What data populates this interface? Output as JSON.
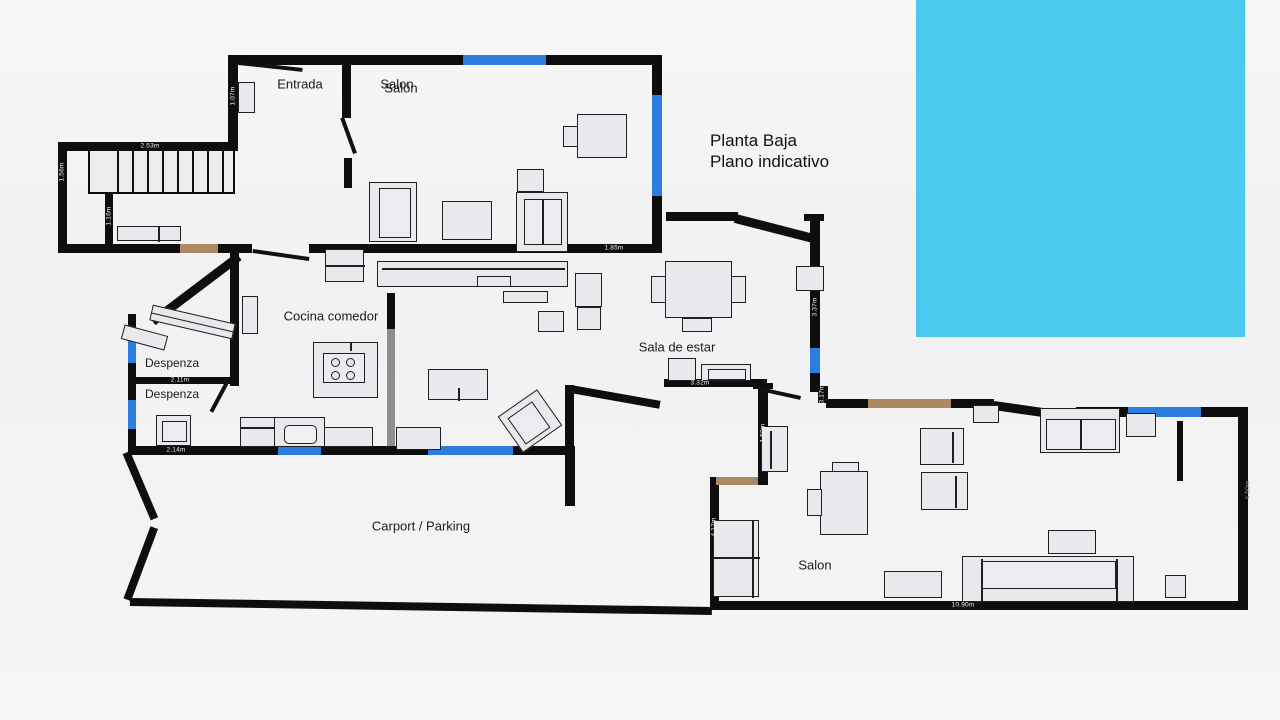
{
  "title": {
    "line1": "Planta Baja",
    "line2": "Plano indicativo"
  },
  "colors": {
    "wall": "#0e0e0e",
    "window_marker": "#2b7de0",
    "door_marker": "#ab8a63",
    "pool": "#4dc9f0",
    "furniture_fill": "#e9e9ed",
    "furniture_border": "#1f1f1f",
    "partition_gray": "#8f8f8f",
    "background": "#f3f3f4",
    "label_text": "#1b1b1b"
  },
  "pool": {
    "name": "swimming-pool",
    "x": 916,
    "y": 0,
    "w": 329,
    "h": 337
  },
  "room_labels": [
    {
      "name": "room-label-entrada",
      "text": "Entrada",
      "x": 300,
      "y": 84,
      "size": 13
    },
    {
      "name": "room-label-salon-top",
      "text": "Salon",
      "x": 397,
      "y": 84,
      "size": 13
    },
    {
      "name": "room-label-salon-top-alt",
      "text": "Salón",
      "x": 401,
      "y": 88,
      "size": 13
    },
    {
      "name": "room-label-cocina",
      "text": "Cocina comedor",
      "x": 331,
      "y": 316,
      "size": 13
    },
    {
      "name": "room-label-sala-de-estar",
      "text": "Sala de estar",
      "x": 677,
      "y": 347,
      "size": 13
    },
    {
      "name": "room-label-despenza-1",
      "text": "Despenza",
      "x": 172,
      "y": 363,
      "size": 12
    },
    {
      "name": "room-label-despenza-2",
      "text": "Despenza",
      "x": 172,
      "y": 394,
      "size": 12
    },
    {
      "name": "room-label-carport",
      "text": "Carport / Parking",
      "x": 421,
      "y": 526,
      "size": 13
    },
    {
      "name": "room-label-salon-bottom",
      "text": "Salon",
      "x": 815,
      "y": 565,
      "size": 13
    }
  ],
  "dimension_labels": [
    {
      "text": "2.53m",
      "x": 150,
      "y": 146,
      "rot": false
    },
    {
      "text": "1.56m",
      "x": 62,
      "y": 172,
      "rot": true
    },
    {
      "text": "1.16m",
      "x": 109,
      "y": 216,
      "rot": true
    },
    {
      "text": "1.07m",
      "x": 233,
      "y": 96,
      "rot": true
    },
    {
      "text": "2.72m",
      "x": 483,
      "y": 291,
      "rot": false
    },
    {
      "text": "1.85m",
      "x": 614,
      "y": 248,
      "rot": false
    },
    {
      "text": "1.54m",
      "x": 569,
      "y": 322,
      "rot": true
    },
    {
      "text": "2.11m",
      "x": 180,
      "y": 380,
      "rot": false
    },
    {
      "text": "2.14m",
      "x": 176,
      "y": 450,
      "rot": false
    },
    {
      "text": "3.37m",
      "x": 815,
      "y": 307,
      "rot": true
    },
    {
      "text": "3.32m",
      "x": 700,
      "y": 383,
      "rot": false
    },
    {
      "text": "3.17m",
      "x": 822,
      "y": 394,
      "rot": true
    },
    {
      "text": "1.50m",
      "x": 763,
      "y": 433,
      "rot": true
    },
    {
      "text": "4.17m",
      "x": 714,
      "y": 527,
      "rot": true
    },
    {
      "text": "10.90m",
      "x": 963,
      "y": 605,
      "rot": false
    },
    {
      "text": "4.50m",
      "x": 1248,
      "y": 490,
      "rot": true,
      "dark": true
    }
  ],
  "plan": {
    "walls": [
      {
        "x": 228,
        "y": 55,
        "w": 434,
        "h": 10
      },
      {
        "x": 228,
        "y": 55,
        "w": 10,
        "h": 92
      },
      {
        "x": 58,
        "y": 142,
        "w": 180,
        "h": 9
      },
      {
        "x": 58,
        "y": 142,
        "w": 9,
        "h": 111
      },
      {
        "x": 58,
        "y": 244,
        "w": 600,
        "h": 9
      },
      {
        "x": 105,
        "y": 190,
        "w": 8,
        "h": 58
      },
      {
        "x": 342,
        "y": 55,
        "w": 9,
        "h": 63
      },
      {
        "x": 344,
        "y": 158,
        "w": 8,
        "h": 30
      },
      {
        "x": 652,
        "y": 55,
        "w": 10,
        "h": 198
      },
      {
        "x": 666,
        "y": 212,
        "w": 72,
        "h": 9
      },
      {
        "x": 804,
        "y": 214,
        "w": 20,
        "h": 7
      },
      {
        "x": 810,
        "y": 216,
        "w": 10,
        "h": 176
      },
      {
        "x": 230,
        "y": 252,
        "w": 9,
        "h": 134
      },
      {
        "x": 128,
        "y": 314,
        "w": 8,
        "h": 141
      },
      {
        "x": 128,
        "y": 377,
        "w": 108,
        "h": 7
      },
      {
        "x": 128,
        "y": 446,
        "w": 447,
        "h": 9
      },
      {
        "x": 565,
        "y": 446,
        "w": 10,
        "h": 60
      },
      {
        "x": 565,
        "y": 385,
        "w": 9,
        "h": 64
      },
      {
        "x": 664,
        "y": 379,
        "w": 103,
        "h": 8
      },
      {
        "x": 753,
        "y": 383,
        "w": 20,
        "h": 6
      },
      {
        "x": 758,
        "y": 385,
        "w": 10,
        "h": 99
      },
      {
        "x": 710,
        "y": 477,
        "w": 58,
        "h": 8
      },
      {
        "x": 710,
        "y": 477,
        "w": 9,
        "h": 133
      },
      {
        "x": 818,
        "y": 386,
        "w": 10,
        "h": 17
      },
      {
        "x": 826,
        "y": 399,
        "w": 168,
        "h": 9
      },
      {
        "x": 1076,
        "y": 407,
        "w": 172,
        "h": 10
      },
      {
        "x": 1238,
        "y": 407,
        "w": 10,
        "h": 203
      },
      {
        "x": 710,
        "y": 601,
        "w": 538,
        "h": 9
      },
      {
        "x": 1177,
        "y": 421,
        "w": 6,
        "h": 60
      },
      {
        "x": 387,
        "y": 293,
        "w": 8,
        "h": 153,
        "color": "#8f8f8f"
      },
      {
        "x": 387,
        "y": 293,
        "w": 8,
        "h": 36
      }
    ],
    "diagonal_walls": [
      {
        "x1": 736,
        "y1": 214,
        "x2": 814,
        "y2": 234,
        "t": 9
      },
      {
        "x1": 150,
        "y1": 318,
        "x2": 236,
        "y2": 253,
        "t": 9
      },
      {
        "x1": 571,
        "y1": 385,
        "x2": 661,
        "y2": 401,
        "t": 8
      },
      {
        "x1": 994,
        "y1": 401,
        "x2": 1078,
        "y2": 413,
        "t": 9
      },
      {
        "x1": 130,
        "y1": 451,
        "x2": 158,
        "y2": 517,
        "t": 8
      },
      {
        "x1": 158,
        "y1": 529,
        "x2": 131,
        "y2": 601,
        "t": 8
      },
      {
        "x1": 130,
        "y1": 598,
        "x2": 712,
        "y2": 607,
        "t": 8
      }
    ],
    "wall_gaps": [
      {
        "x": 252,
        "y": 243,
        "w": 57,
        "h": 11
      }
    ],
    "windows": [
      {
        "x": 463,
        "y": 55,
        "w": 83,
        "h": 10
      },
      {
        "x": 652,
        "y": 95,
        "w": 10,
        "h": 101
      },
      {
        "x": 810,
        "y": 348,
        "w": 10,
        "h": 25
      },
      {
        "x": 128,
        "y": 337,
        "w": 8,
        "h": 26
      },
      {
        "x": 128,
        "y": 400,
        "w": 8,
        "h": 29
      },
      {
        "x": 278,
        "y": 446,
        "w": 43,
        "h": 9
      },
      {
        "x": 428,
        "y": 446,
        "w": 85,
        "h": 9
      },
      {
        "x": 1128,
        "y": 407,
        "w": 73,
        "h": 10
      }
    ],
    "doors": [
      {
        "x": 180,
        "y": 244,
        "w": 38,
        "h": 9
      },
      {
        "x": 868,
        "y": 399,
        "w": 83,
        "h": 9
      },
      {
        "x": 716,
        "y": 477,
        "w": 42,
        "h": 8
      }
    ],
    "door_leaves": [
      {
        "x1": 239,
        "y1": 61,
        "x2": 303,
        "y2": 68
      },
      {
        "x1": 344,
        "y1": 117,
        "x2": 357,
        "y2": 153
      },
      {
        "x1": 253,
        "y1": 249,
        "x2": 309,
        "y2": 257
      },
      {
        "x1": 230,
        "y1": 381,
        "x2": 213,
        "y2": 413
      },
      {
        "x1": 760,
        "y1": 387,
        "x2": 801,
        "y2": 396
      }
    ],
    "stairs": {
      "x": 88,
      "y": 149,
      "w": 147,
      "h": 45,
      "risers": [
        27,
        42,
        57,
        72,
        87,
        102,
        117,
        132
      ]
    },
    "furniture": [
      {
        "name": "wardrobe",
        "x": 238,
        "y": 82,
        "w": 17,
        "h": 31
      },
      {
        "name": "bench",
        "x": 117,
        "y": 226,
        "w": 64,
        "h": 15,
        "inner": [
          {
            "kind": "line",
            "x": 40,
            "y": 0,
            "w": 1.5,
            "h": 15
          }
        ]
      },
      {
        "name": "desk",
        "x": 577,
        "y": 114,
        "w": 50,
        "h": 44
      },
      {
        "name": "desk-chair",
        "x": 563,
        "y": 126,
        "w": 15,
        "h": 21
      },
      {
        "name": "side-table",
        "x": 517,
        "y": 169,
        "w": 27,
        "h": 23
      },
      {
        "name": "sofa",
        "x": 369,
        "y": 182,
        "w": 48,
        "h": 60,
        "inner": [
          {
            "kind": "rect",
            "x": 9,
            "y": 5,
            "w": 32,
            "h": 50
          }
        ]
      },
      {
        "name": "coffee-table",
        "x": 442,
        "y": 201,
        "w": 50,
        "h": 39
      },
      {
        "name": "armchair",
        "x": 516,
        "y": 192,
        "w": 52,
        "h": 60,
        "inner": [
          {
            "kind": "rect",
            "x": 7,
            "y": 6,
            "w": 38,
            "h": 46
          },
          {
            "kind": "line",
            "x": 25,
            "y": 6,
            "w": 1.5,
            "h": 46
          }
        ]
      },
      {
        "name": "sideboard",
        "x": 377,
        "y": 261,
        "w": 191,
        "h": 26,
        "inner": [
          {
            "kind": "line",
            "x": 4,
            "y": 6,
            "w": 183,
            "h": 1.5
          }
        ]
      },
      {
        "name": "shelf-box",
        "x": 477,
        "y": 276,
        "w": 34,
        "h": 11
      },
      {
        "name": "shelf",
        "x": 503,
        "y": 291,
        "w": 45,
        "h": 12
      },
      {
        "name": "fridge",
        "x": 325,
        "y": 249,
        "w": 39,
        "h": 33,
        "inner": [
          {
            "kind": "line",
            "x": 0,
            "y": 15,
            "w": 39,
            "h": 1.5
          }
        ]
      },
      {
        "name": "tall-cabinet",
        "x": 242,
        "y": 296,
        "w": 16,
        "h": 38
      },
      {
        "name": "kitchen-island",
        "x": 313,
        "y": 342,
        "w": 65,
        "h": 56,
        "inner": [
          {
            "kind": "rect",
            "x": 9,
            "y": 10,
            "w": 42,
            "h": 30
          },
          {
            "kind": "circle",
            "cx": 21,
            "cy": 19,
            "r": 4.5
          },
          {
            "kind": "circle",
            "cx": 36,
            "cy": 19,
            "r": 4.5
          },
          {
            "kind": "circle",
            "cx": 21,
            "cy": 32,
            "r": 4.5
          },
          {
            "kind": "circle",
            "cx": 36,
            "cy": 32,
            "r": 4.5
          },
          {
            "kind": "line",
            "x": 36,
            "y": 0,
            "w": 1.5,
            "h": 8
          }
        ]
      },
      {
        "name": "cabinet",
        "x": 240,
        "y": 417,
        "w": 35,
        "h": 30,
        "inner": [
          {
            "kind": "line",
            "x": 0,
            "y": 9,
            "w": 35,
            "h": 1.5
          }
        ]
      },
      {
        "name": "sink-unit",
        "x": 274,
        "y": 417,
        "w": 51,
        "h": 30,
        "inner": [
          {
            "kind": "round",
            "x": 9,
            "y": 7,
            "w": 33,
            "h": 19
          }
        ]
      },
      {
        "name": "counter",
        "x": 324,
        "y": 427,
        "w": 49,
        "h": 20
      },
      {
        "name": "counter",
        "x": 396,
        "y": 427,
        "w": 45,
        "h": 23
      },
      {
        "name": "tv-bench",
        "x": 428,
        "y": 369,
        "w": 60,
        "h": 31,
        "inner": [
          {
            "kind": "line",
            "x": 29,
            "y": 18,
            "w": 1.5,
            "h": 13
          }
        ]
      },
      {
        "name": "armchair",
        "x": 506,
        "y": 399,
        "w": 48,
        "h": 44,
        "rot": -35,
        "inner": [
          {
            "kind": "rect",
            "x": 6,
            "y": 6,
            "w": 30,
            "h": 32
          }
        ]
      },
      {
        "name": "shelf",
        "x": 150,
        "y": 314,
        "w": 85,
        "h": 16,
        "rot": 13,
        "inner": [
          {
            "kind": "line",
            "x": 0,
            "y": 7,
            "w": 85,
            "h": 1.3
          }
        ]
      },
      {
        "name": "shelf",
        "x": 122,
        "y": 330,
        "w": 45,
        "h": 15,
        "rot": 15
      },
      {
        "name": "appliance",
        "x": 156,
        "y": 415,
        "w": 35,
        "h": 31,
        "inner": [
          {
            "kind": "rect",
            "x": 5,
            "y": 5,
            "w": 25,
            "h": 21
          }
        ]
      },
      {
        "name": "dining-table",
        "x": 665,
        "y": 261,
        "w": 67,
        "h": 57
      },
      {
        "name": "chair",
        "x": 651,
        "y": 276,
        "w": 15,
        "h": 27
      },
      {
        "name": "chair",
        "x": 731,
        "y": 276,
        "w": 15,
        "h": 27
      },
      {
        "name": "chair",
        "x": 682,
        "y": 318,
        "w": 30,
        "h": 14
      },
      {
        "name": "chair",
        "x": 796,
        "y": 266,
        "w": 28,
        "h": 25
      },
      {
        "name": "desk",
        "x": 575,
        "y": 273,
        "w": 27,
        "h": 34
      },
      {
        "name": "chair",
        "x": 577,
        "y": 307,
        "w": 24,
        "h": 23
      },
      {
        "name": "chair",
        "x": 538,
        "y": 311,
        "w": 26,
        "h": 21
      },
      {
        "name": "cabinet",
        "x": 668,
        "y": 358,
        "w": 28,
        "h": 23
      },
      {
        "name": "cabinet",
        "x": 701,
        "y": 364,
        "w": 50,
        "h": 17,
        "inner": [
          {
            "kind": "rect",
            "x": 6,
            "y": 4,
            "w": 38,
            "h": 11
          }
        ]
      },
      {
        "name": "wardrobe",
        "x": 761,
        "y": 426,
        "w": 27,
        "h": 46,
        "inner": [
          {
            "kind": "line",
            "x": 8,
            "y": 4,
            "w": 1.5,
            "h": 38
          }
        ]
      },
      {
        "name": "tall-cabinet",
        "x": 713,
        "y": 520,
        "w": 46,
        "h": 77,
        "inner": [
          {
            "kind": "line",
            "x": 0,
            "y": 36,
            "w": 46,
            "h": 1.5
          },
          {
            "kind": "line",
            "x": 38,
            "y": 0,
            "w": 1.5,
            "h": 77
          }
        ]
      },
      {
        "name": "desk",
        "x": 820,
        "y": 471,
        "w": 48,
        "h": 64
      },
      {
        "name": "desk-item",
        "x": 832,
        "y": 462,
        "w": 27,
        "h": 10
      },
      {
        "name": "desk-chair",
        "x": 807,
        "y": 489,
        "w": 15,
        "h": 27
      },
      {
        "name": "armchair",
        "x": 920,
        "y": 428,
        "w": 44,
        "h": 37,
        "inner": [
          {
            "kind": "line",
            "x": 31,
            "y": 3,
            "w": 1.5,
            "h": 31
          }
        ]
      },
      {
        "name": "armchair",
        "x": 921,
        "y": 472,
        "w": 47,
        "h": 38,
        "inner": [
          {
            "kind": "line",
            "x": 33,
            "y": 3,
            "w": 1.5,
            "h": 32
          }
        ]
      },
      {
        "name": "shelf",
        "x": 973,
        "y": 405,
        "w": 26,
        "h": 18
      },
      {
        "name": "loveseat",
        "x": 1040,
        "y": 408,
        "w": 80,
        "h": 45,
        "inner": [
          {
            "kind": "rect",
            "x": 5,
            "y": 10,
            "w": 70,
            "h": 31
          },
          {
            "kind": "line",
            "x": 39,
            "y": 10,
            "w": 1.5,
            "h": 31
          }
        ]
      },
      {
        "name": "side-table",
        "x": 1126,
        "y": 413,
        "w": 30,
        "h": 24
      },
      {
        "name": "coffee-table",
        "x": 1048,
        "y": 530,
        "w": 48,
        "h": 24
      },
      {
        "name": "sofa",
        "x": 962,
        "y": 556,
        "w": 172,
        "h": 46,
        "inner": [
          {
            "kind": "line",
            "x": 18,
            "y": 2,
            "w": 1.5,
            "h": 42
          },
          {
            "kind": "line",
            "x": 153,
            "y": 2,
            "w": 1.5,
            "h": 42
          },
          {
            "kind": "rect",
            "x": 19,
            "y": 4,
            "w": 134,
            "h": 28
          }
        ]
      },
      {
        "name": "side-table",
        "x": 884,
        "y": 571,
        "w": 58,
        "h": 27
      },
      {
        "name": "side-table",
        "x": 1165,
        "y": 575,
        "w": 21,
        "h": 23
      }
    ]
  }
}
